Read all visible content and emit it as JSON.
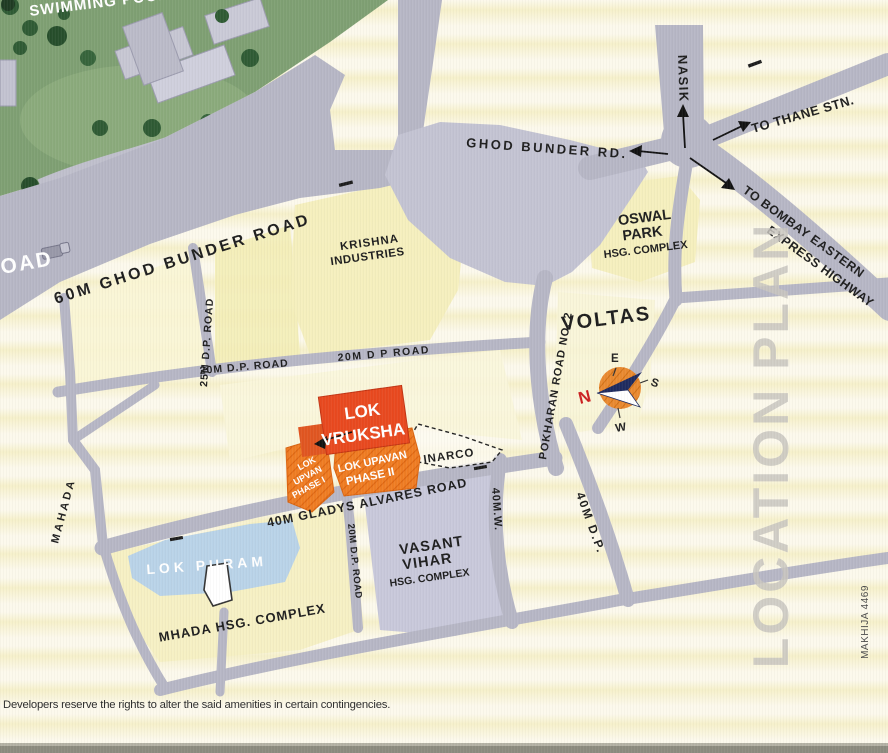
{
  "labels": {
    "swimming_pool": "SWIMMING POOL",
    "road_edge": "ROAD",
    "ghod_bunder_60m": "60M GHOD BUNDER ROAD",
    "ghod_bunder_rd": "GHOD BUNDER RD.",
    "nasik": "NASIK",
    "to_thane": "TO THANE STN.",
    "to_bombay": [
      "TO BOMBAY EASTERN",
      "EXPRESS HIGHWAY"
    ],
    "krishna": [
      "KRISHNA",
      "INDUSTRIES"
    ],
    "oswal": [
      "OSWAL",
      "PARK",
      "HSG. COMPLEX"
    ],
    "voltas": "VOLTAS",
    "pokharan": "POKHARAN ROAD NO. 2",
    "dp_25m": "25M D.P. ROAD",
    "dp_20m_left": "20M D.P. ROAD",
    "dp_20m_right": "20M D P ROAD",
    "dp_20m_vert": "20M D.P. ROAD",
    "mahada": "MAHADA",
    "gladys": "40M GLADYS ALVARES ROAD",
    "w_40m": "40M.W.",
    "dp_40m": "40M D.P.",
    "lok_vruksha": [
      "LOK",
      "VRUKSHA"
    ],
    "lok_upvan_phase1": [
      "LOK",
      "UPVAN",
      "PHASE I"
    ],
    "lok_upavan_phase2": [
      "LOK UPAVAN",
      "PHASE II"
    ],
    "inarco": "INARCO",
    "lok_puram": "LOK PURAM",
    "vasant": [
      "VASANT",
      "VIHAR",
      "HSG. COMPLEX"
    ],
    "mhada": "MHADA HSG. COMPLEX",
    "compass": {
      "n": "N",
      "e": "E",
      "s": "S",
      "w": "W"
    },
    "location_plan": "LOCATION PLAN",
    "makhija": "MAKHIJA 4469"
  },
  "footer": {
    "disclaimer": "Developers reserve the rights to alter the said amenities in certain contingencies."
  },
  "colors": {
    "accent_red": "#e8481e",
    "plot_orange": "#ef7c22",
    "road_gray": "#b6b6c5",
    "junction_gray": "#c3c3d2",
    "map_cream": "#fcf9ec",
    "lok_puram_blue": "#b9d3e8",
    "site_green": "#7e9f72",
    "compass_orange": "#e9892f"
  }
}
